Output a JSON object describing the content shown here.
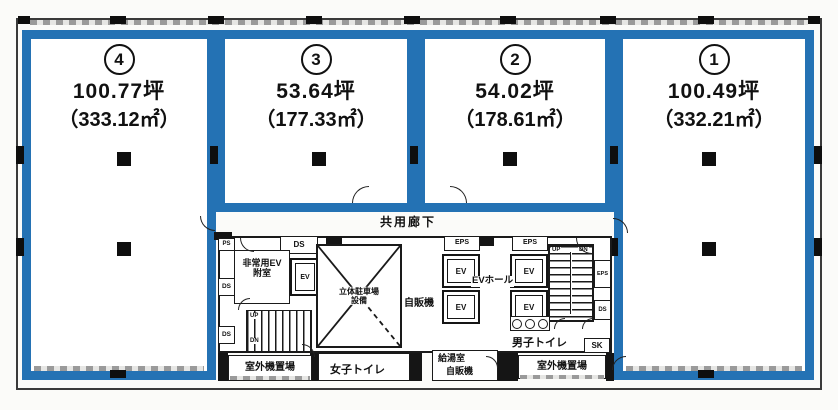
{
  "units": [
    {
      "number": "4",
      "tsubo": "100.77坪",
      "sqm": "（333.12㎡）"
    },
    {
      "number": "3",
      "tsubo": "53.64坪",
      "sqm": "（177.33㎡）"
    },
    {
      "number": "2",
      "tsubo": "54.02坪",
      "sqm": "（178.61㎡）"
    },
    {
      "number": "1",
      "tsubo": "100.49坪",
      "sqm": "（332.21㎡）"
    }
  ],
  "labels": {
    "corridor": "共用廊下",
    "emergency_ev": "非常用EV",
    "vestibule": "附室",
    "ev": "EV",
    "ev_hall": "EVホール",
    "parking_1": "立体駐車場",
    "parking_2": "設備",
    "vending": "自販機",
    "kitchen": "給湯室",
    "mens_toilet": "男子トイレ",
    "womens_toilet": "女子トイレ",
    "sk": "SK",
    "outdoor_units": "室外機置場",
    "ds": "DS",
    "ps": "PS",
    "eps": "EPS",
    "up": "UP",
    "dn": "DN"
  },
  "colors": {
    "unit_border": "#2472b4",
    "wall": "#151515",
    "hatch": "#9a9a9a"
  }
}
